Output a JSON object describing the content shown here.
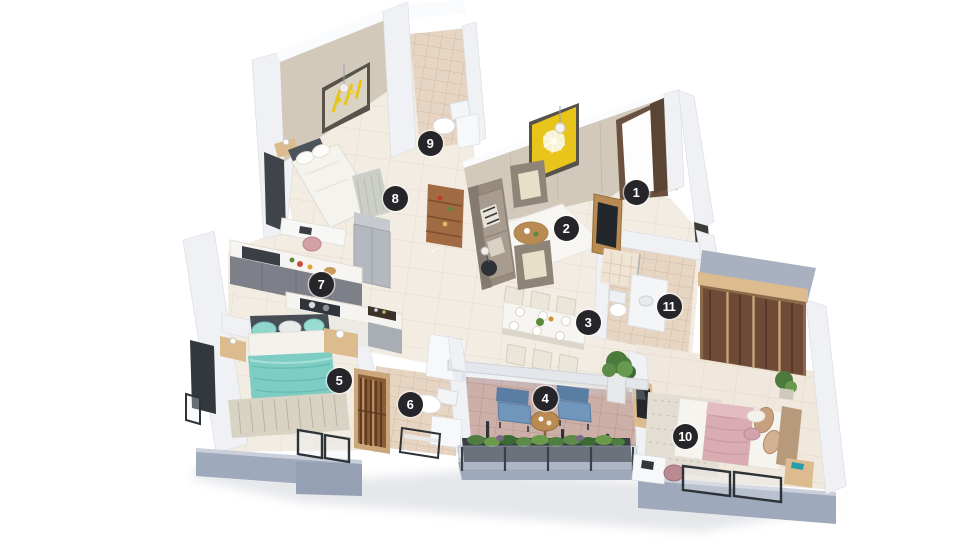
{
  "figure": {
    "type": "3d-isometric-floor-plan",
    "background": "#ffffff",
    "rooms_marked": 11
  },
  "markers": [
    {
      "n": "1",
      "x": 636,
      "y": 192
    },
    {
      "n": "2",
      "x": 566,
      "y": 228
    },
    {
      "n": "3",
      "x": 588,
      "y": 322
    },
    {
      "n": "4",
      "x": 545,
      "y": 398
    },
    {
      "n": "5",
      "x": 339,
      "y": 380
    },
    {
      "n": "6",
      "x": 410,
      "y": 404
    },
    {
      "n": "7",
      "x": 321,
      "y": 284
    },
    {
      "n": "8",
      "x": 395,
      "y": 198
    },
    {
      "n": "9",
      "x": 430,
      "y": 143
    },
    {
      "n": "10",
      "x": 685,
      "y": 436
    },
    {
      "n": "11",
      "x": 669,
      "y": 306
    }
  ],
  "palette": {
    "marker_bg": "#26262a",
    "marker_text": "#ffffff",
    "floor": "#f2ece3",
    "floor_warm": "#f0e8dc",
    "bath_floor": "#e7d5c3",
    "balcony_floor": "#ccb0a8",
    "wall": "#f0f1f4",
    "wall_beige": "#d2c9bb",
    "slab": "#9fa9bc",
    "slab_light": "#c9d0dc",
    "accent_yellow": "#e9c51c",
    "teal": "#7ecdc4",
    "pink": "#d8acb2",
    "blue": "#7096bc",
    "wood": "#b98a52",
    "wood_light": "#dcbc8e",
    "glass_brown": "#6f4a36",
    "plant": "#4c7a3c",
    "gray_cabinet": "#7d8089"
  }
}
